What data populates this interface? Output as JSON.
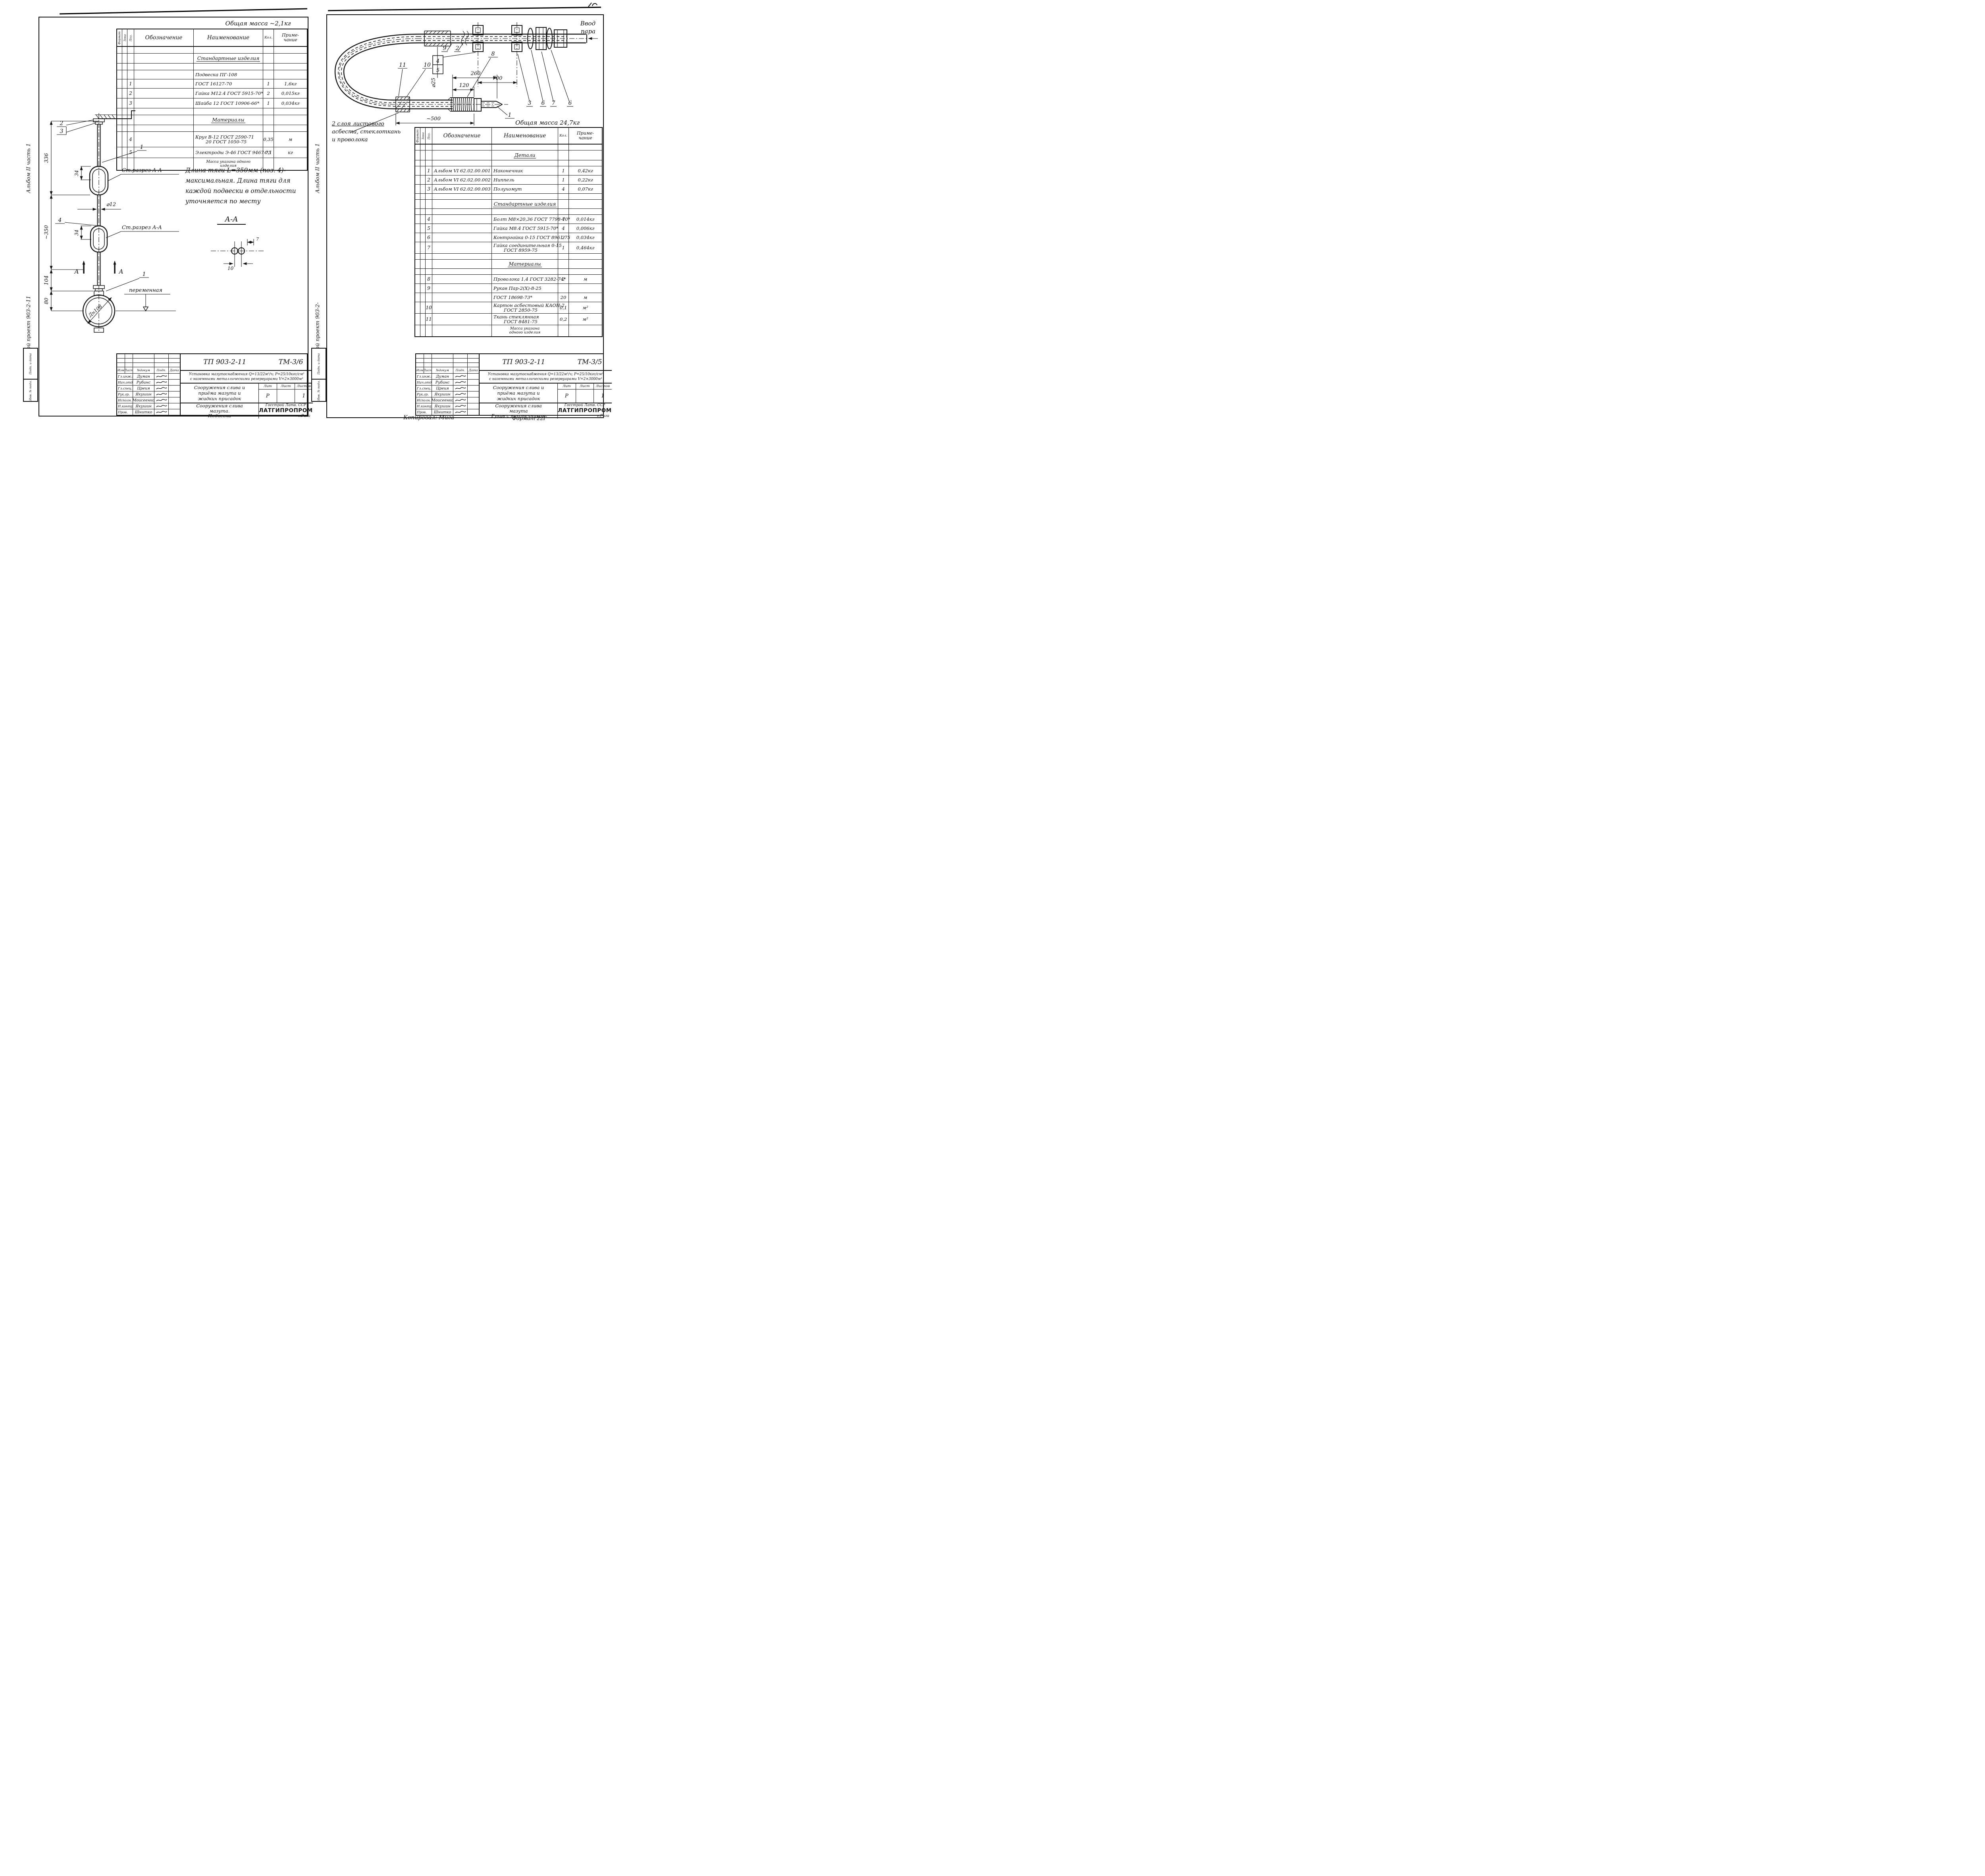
{
  "spec_headers": {
    "format": "Формат",
    "zone": "Зона",
    "pos": "Поз.",
    "des": "Обозначение",
    "name": "Наименование",
    "qty": "Кол.",
    "note1": "Приме-",
    "note2": "чание"
  },
  "title_common": {
    "header_cols": [
      "Изм",
      "Лист",
      "№докум",
      "Подп.",
      "Дата"
    ],
    "lit_cols": [
      "Лит",
      "Лист",
      "Листов"
    ]
  },
  "footer": {
    "copied": "Копировал: Мига",
    "format": "Формат 22Г"
  },
  "left_sheet": {
    "margin": {
      "project": "Типовой проект 903-2-11",
      "album": "Альбом II часть 1",
      "stamp_top": "Подп. и дата",
      "stamp_bottom": "Инв. № подл."
    },
    "mass_note": "Общая масса ~2,1кг",
    "spec_rows": [
      {
        "type": "empty",
        "h": 16
      },
      {
        "type": "section",
        "name": "Стандартные изделия",
        "h": 24
      },
      {
        "type": "empty",
        "h": 16
      },
      {
        "type": "item",
        "pos": "",
        "des": "",
        "name": "Подвеска ПГ-108",
        "qty": "",
        "note": "",
        "h": 22
      },
      {
        "type": "item",
        "pos": "1",
        "des": "",
        "name": "ГОСТ 16127-70",
        "qty": "1",
        "note": "1,6кг",
        "h": 22
      },
      {
        "type": "item",
        "pos": "2",
        "des": "",
        "name": "Гайка М12.4 ГОСТ 5915-70*",
        "qty": "2",
        "note": "0,015кг",
        "h": 24
      },
      {
        "type": "item",
        "pos": "3",
        "des": "",
        "name": "Шайба 12 ГОСТ 10906-66*",
        "qty": "1",
        "note": "0,034кг",
        "h": 24
      },
      {
        "type": "empty",
        "h": 16
      },
      {
        "type": "section",
        "name": "Материалы",
        "h": 24
      },
      {
        "type": "empty",
        "h": 16
      },
      {
        "type": "item",
        "pos": "4",
        "des": "",
        "name": "Круг  В-12 ГОСТ 2590-71",
        "name2": "20 ГОСТ 1050-75",
        "qty": "0,35",
        "note": "м",
        "h": 38
      },
      {
        "type": "item",
        "pos": "5",
        "des": "",
        "name": "Электроды Э-46 ГОСТ 9467-75",
        "qty": "0,1",
        "note": "кг",
        "h": 26
      },
      {
        "type": "note",
        "name": "Масса указана одного",
        "name2": "изделия",
        "h": 30
      }
    ],
    "note_lines": [
      "Длина тяги L=350мм (поз. 4)-",
      "максимальная. Длина тяги для",
      "каждой подвески в отдельности",
      "уточняется по месту"
    ],
    "draw": {
      "aa": "А-А",
      "d336": "336",
      "d350": "~350",
      "d34a": "34",
      "d34b": "34",
      "d104": "104",
      "d80": "80",
      "dia12": "⌀12",
      "l1a": "1",
      "l1b": "1",
      "l2": "2",
      "l3": "3",
      "l4": "4",
      "cut1": "Ст.разрез А-А",
      "cut2": "Ст.разрез А-А",
      "var": "переменная",
      "dn": "Дн108",
      "aL": "А",
      "aR": "А",
      "s10": "10",
      "s7": "7"
    },
    "title_block": {
      "doc": "ТП 903-2-11",
      "code": "ТМ-3/6",
      "title1": "Установка мазутоснабжения Q=13/22м³/ч; Р=25/10кгс/см²",
      "title2": "с наземными металлическими резервуарами V=2×3000м³",
      "object": [
        "Сооружения слива и",
        "приёма мазута и",
        "жидких присадок"
      ],
      "lit": [
        "Р",
        "",
        "1"
      ],
      "name": [
        "Сооружения слива",
        "мазута.",
        "Подвеска"
      ],
      "org": [
        "Госстрой Латв. ССР",
        "ЛАТГИПРОПРОМ",
        "г.Рига"
      ],
      "people": [
        [
          "Гл.инж.пр",
          "Думан"
        ],
        [
          "Нач.отд.",
          "Рубинс"
        ],
        [
          "Гл.спец.",
          "Цреия"
        ],
        [
          "Рук.гр.",
          "Якушин"
        ],
        [
          "Исполн.",
          "Моисеенко"
        ],
        [
          "Н.контр.",
          "Якушин"
        ],
        [
          "Пров.",
          "Шнитко"
        ]
      ]
    }
  },
  "right_sheet": {
    "margin": {
      "project": "Типовой проект 903-2-",
      "album": "Альбом II часть 1",
      "stamp_top": "Подп. и дата",
      "stamp_bottom": "Инв. № подл."
    },
    "mass_note": "Общая масса 24,7кг",
    "spec_rows": [
      {
        "type": "empty",
        "h": 14
      },
      {
        "type": "section",
        "name": "Детали",
        "h": 24
      },
      {
        "type": "empty",
        "h": 14
      },
      {
        "type": "item",
        "pos": "1",
        "des": "Альбом VI  62.02.00.001",
        "name": "Наконечник",
        "qty": "1",
        "note": "0,42кг",
        "h": 22
      },
      {
        "type": "item",
        "pos": "2",
        "des": "Альбом VI  62.02.00.002",
        "name": "Ниппель",
        "qty": "1",
        "note": "0,22кг",
        "h": 22
      },
      {
        "type": "item",
        "pos": "3",
        "des": "Альбом VI  62.02.00.003",
        "name": "Полухомут",
        "qty": "4",
        "note": "0,07кг",
        "h": 22
      },
      {
        "type": "empty",
        "h": 14
      },
      {
        "type": "section",
        "name": "Стандартные изделия",
        "h": 22
      },
      {
        "type": "empty",
        "h": 14
      },
      {
        "type": "item",
        "pos": "4",
        "des": "",
        "name": "Болт М8×20,36 ГОСТ 7798-70*",
        "qty": "4",
        "note": "0,014кг",
        "h": 22
      },
      {
        "type": "item",
        "pos": "5",
        "des": "",
        "name": "Гайка М8.4 ГОСТ 5915-70*",
        "qty": "4",
        "note": "0,006кг",
        "h": 22
      },
      {
        "type": "item",
        "pos": "6",
        "des": "",
        "name": "Контргайка 0-15 ГОСТ 8961-75",
        "qty": "2",
        "note": "0,034кг",
        "h": 22
      },
      {
        "type": "item",
        "pos": "7",
        "des": "",
        "name": "Гайка соединительная 0-15",
        "name2": "ГОСТ 8959-75",
        "qty": "1",
        "note": "0,464кг",
        "h": 28
      },
      {
        "type": "empty",
        "h": 14
      },
      {
        "type": "section",
        "name": "Материалы",
        "h": 22
      },
      {
        "type": "empty",
        "h": 14
      },
      {
        "type": "item",
        "pos": "8",
        "des": "",
        "name": "Проволока 1,4 ГОСТ 3282-74*",
        "qty": "2",
        "note": "м",
        "h": 22
      },
      {
        "type": "item",
        "pos": "9",
        "des": "",
        "name": "Рукав Пар-2(Х)-8-25",
        "qty": "",
        "note": "",
        "h": 22
      },
      {
        "type": "item",
        "pos": "",
        "des": "",
        "name": "ГОСТ 18698-73*",
        "qty": "20",
        "note": "м",
        "h": 22
      },
      {
        "type": "item",
        "pos": "10",
        "des": "",
        "name": "Картон асбестовый КАОН-2",
        "name2": "ГОСТ 2850-75",
        "qty": "0,1",
        "note": "м²",
        "h": 28
      },
      {
        "type": "item",
        "pos": "11",
        "des": "",
        "name": "Ткань стеклянная",
        "name2": "ГОСТ 8481-75",
        "qty": "0,2",
        "note": "м²",
        "h": 28
      },
      {
        "type": "note",
        "name": "Масса указана",
        "name2": "одного изделия",
        "h": 28
      }
    ],
    "draw": {
      "dia25": "⌀25",
      "d700": "700",
      "d120": "120",
      "d260": "260",
      "d500": "~500",
      "l1": "1",
      "l2": "2",
      "l3": "3",
      "l4": "4",
      "l5": "5",
      "l6a": "6",
      "l6b": "6",
      "l7": "7",
      "l8": "8",
      "l9": "9",
      "l10": "10",
      "l11": "11",
      "steam1": "Ввод",
      "steam2": "пара",
      "note1": "2 слоя листового",
      "note2": "асбеста, стеклоткань",
      "note3": "и проволока"
    },
    "title_block": {
      "doc": "ТП 903-2-11",
      "code": "ТМ-3/5",
      "title1": "Установка мазутоснабжения Q=13/22м³/ч; Р=25/10кгс/см²",
      "title2": "с наземными металлическими резервуарами V=2×3000м³",
      "object": [
        "Сооружения слива и",
        "приёма мазута и",
        "жидких присадок"
      ],
      "lit": [
        "Р",
        "",
        "1"
      ],
      "name": [
        "Сооружения слива",
        "мазута",
        "Рукав с наконечником"
      ],
      "org": [
        "Госстрой Латв. ССР",
        "ЛАТГИПРОПРОМ",
        "г.Рига"
      ],
      "people": [
        [
          "Гл.инж.пр",
          "Думан"
        ],
        [
          "Нач.отд.",
          "Рубинс"
        ],
        [
          "Гл.спец.",
          "Цреия"
        ],
        [
          "Рук.гр.",
          "Якушин"
        ],
        [
          "Исполн.",
          "Моисеенко"
        ],
        [
          "Н.контр.",
          "Якушин"
        ],
        [
          "Пров.",
          "Шнитко"
        ]
      ]
    }
  }
}
